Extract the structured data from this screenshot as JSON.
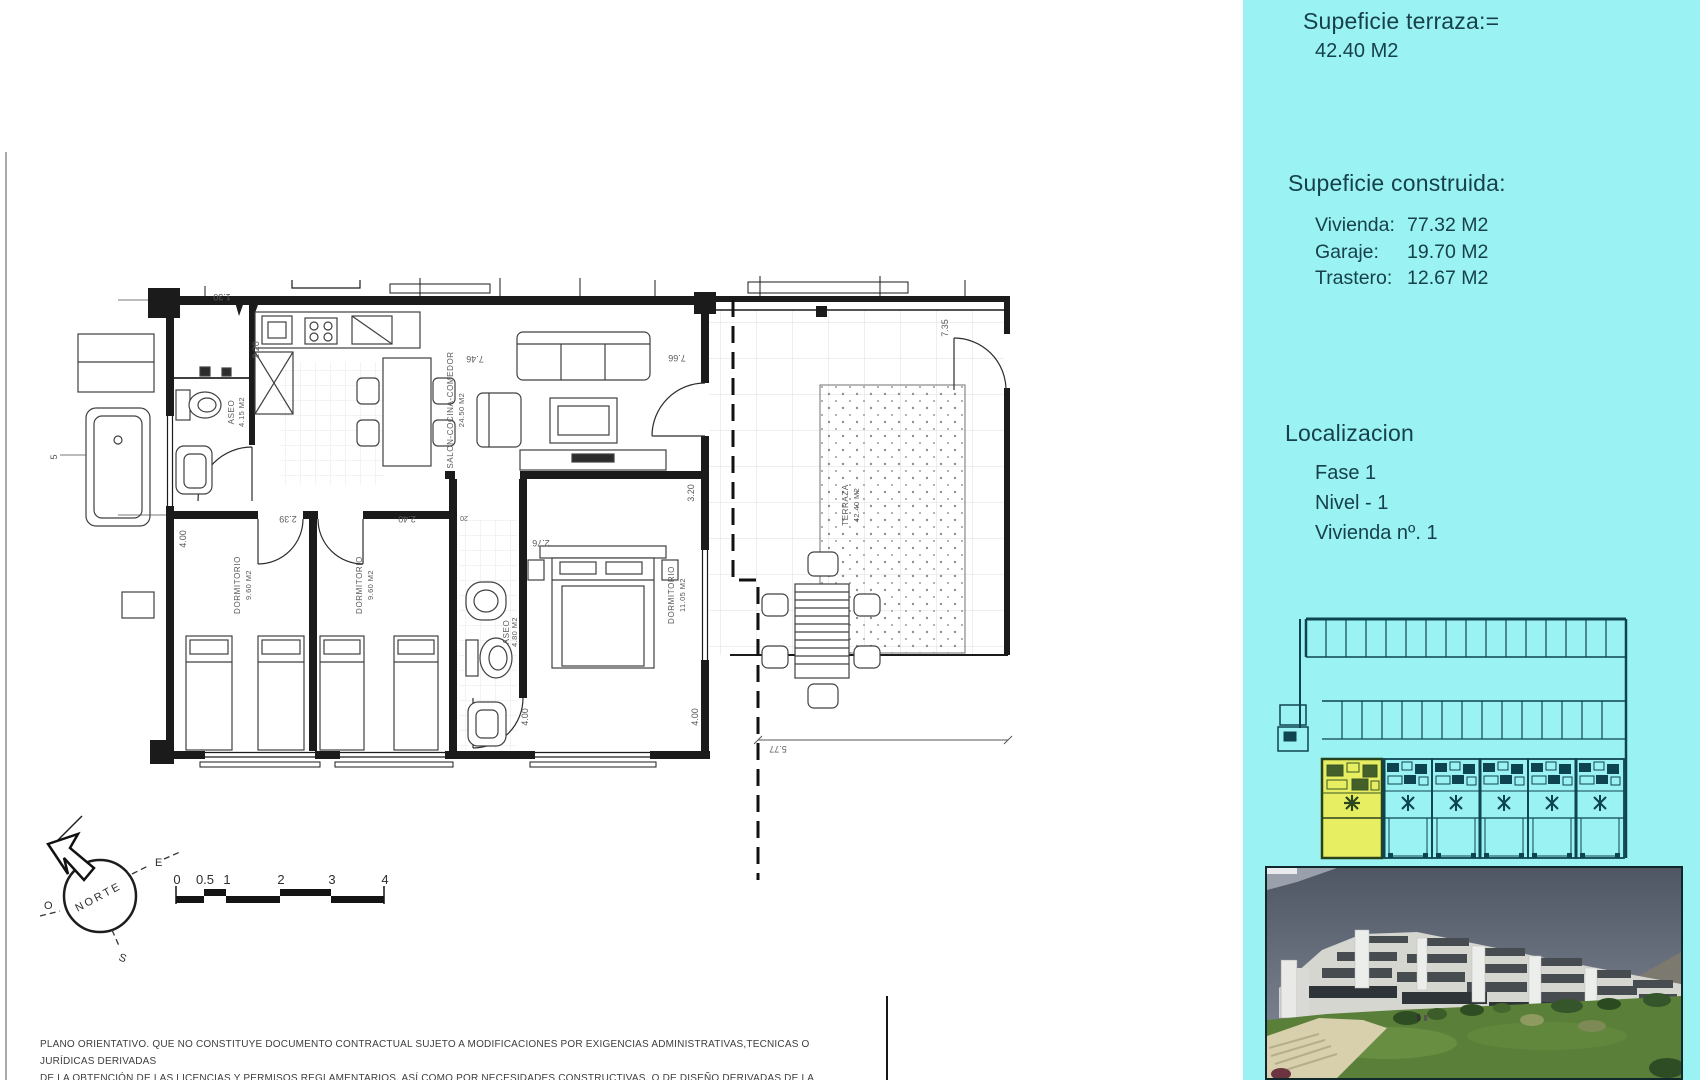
{
  "colors": {
    "sidebar_bg": "#9bf2f2",
    "highlight_unit": "#e7ee62",
    "plan_line": "#1b1b1b"
  },
  "sidebar": {
    "terraza": {
      "title": "Supeficie terraza:=",
      "value": "42.40 M2"
    },
    "construida": {
      "title": "Supeficie construida:",
      "rows": [
        {
          "label": "Vivienda:",
          "value": "77.32 M2"
        },
        {
          "label": "Garaje:",
          "value": "19.70 M2"
        },
        {
          "label": "Trastero:",
          "value": "12.67 M2"
        }
      ]
    },
    "localizacion": {
      "title": "Localizacion",
      "items": [
        "Fase 1",
        "Nivel - 1",
        "Vivienda nº. 1"
      ]
    }
  },
  "floorplan": {
    "rooms": {
      "aseo1": {
        "name": "ASEO",
        "area": "4.15 M2"
      },
      "salon": {
        "name": "SALON-COCINA-COMEDOR",
        "area": "24.50 M2"
      },
      "dorm1": {
        "name": "DORMITORIO",
        "area": "9.60 M2"
      },
      "dorm2": {
        "name": "DORMITORIO",
        "area": "9.60 M2"
      },
      "aseo2": {
        "name": "ASEO",
        "area": "4.80 M2"
      },
      "dorm3": {
        "name": "DORMITORIO",
        "area": "11.05 M2"
      },
      "terraza": {
        "name": "TERRAZA",
        "area": "42.40 M2"
      }
    },
    "dims": {
      "d130": "1.30",
      "d220": "2.20",
      "d746": "7.46",
      "d766": "7.66",
      "d320": "3.20",
      "d239": "2.39",
      "d240": "2.40",
      "d276": "2.76",
      "d020": "20",
      "d400a": "4.00",
      "d400b": "4.00",
      "d400c": "4.00",
      "d577": "5.77",
      "d735": "7.35",
      "d5": "5"
    }
  },
  "compass": {
    "north": "NORTE",
    "east": "E",
    "south": "S",
    "west": "O"
  },
  "scalebar": {
    "ticks": [
      "0",
      "0.5",
      "1",
      "2",
      "3",
      "4"
    ]
  },
  "disclaimer": {
    "line1": "PLANO ORIENTATIVO. QUE NO CONSTITUYE DOCUMENTO CONTRACTUAL SUJETO A MODIFICACIONES POR EXIGENCIAS ADMINISTRATIVAS,TECNICAS O JURÍDICAS DERIVADAS",
    "line2": "DE LA OBTENCIÓN DE LAS LICENCIAS Y PERMISOS REGLAMENTARIOS, ASÍ COMO POR NECESIDADES CONSTRUCTIVAS, O DE DISEÑO DERIVADAS DE LA DIRECCIÓN DE LA OBRA"
  }
}
